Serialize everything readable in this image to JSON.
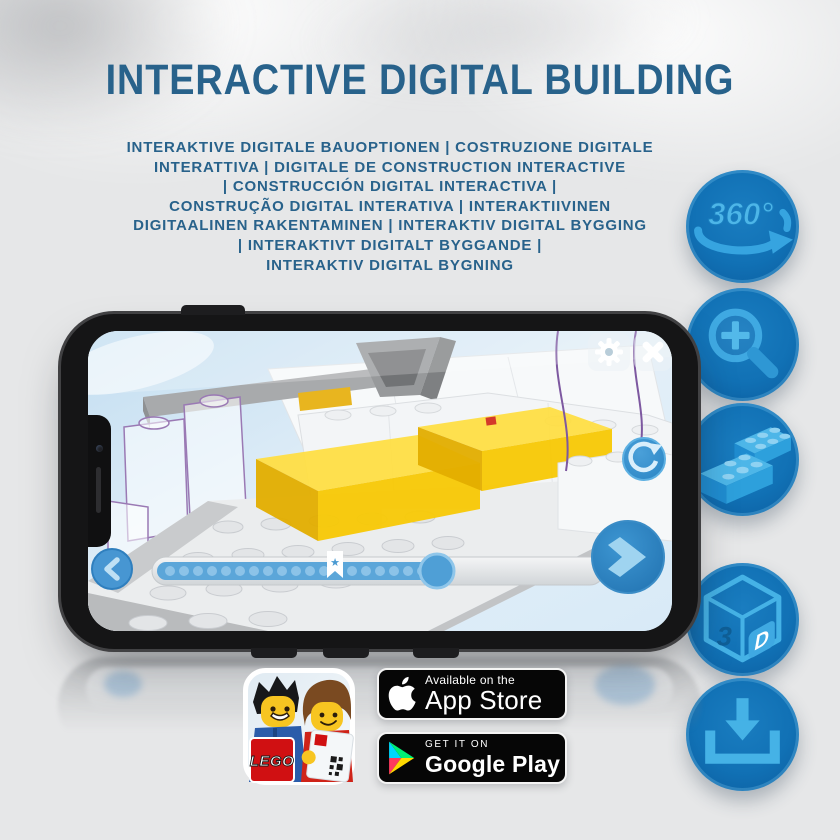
{
  "header": {
    "title": "INTERACTIVE DIGITAL BUILDING",
    "subtitle_lines": [
      "INTERAKTIVE DIGITALE BAUOPTIONEN | COSTRUZIONE DIGITALE",
      "INTERATTIVA | DIGITALE DE CONSTRUCTION INTERACTIVE",
      "| CONSTRUCCIÓN DIGITAL INTERACTIVA |",
      "CONSTRUÇÃO DIGITAL INTERATIVA | INTERAKTIIVINEN",
      "DIGITAALINEN RAKENTAMINEN | INTERAKTIV DIGITAL BYGGING",
      "| INTERAKTIVT DIGITALT BYGGANDE |",
      "INTERAKTIV DIGITAL BYGNING"
    ]
  },
  "feature_icons": {
    "rotate360": {
      "label": "360°"
    },
    "threed": {
      "label_3": "3",
      "label_d": "D"
    }
  },
  "app_icon": {
    "lego_text": "LEGO"
  },
  "badges": {
    "app_store": {
      "tagline": "Available on the",
      "store": "App Store"
    },
    "google_play": {
      "tagline": "GET IT ON",
      "store": "Google Play"
    }
  },
  "colors": {
    "background": "#e6e7e8",
    "title_blue": "#28628b",
    "icon_circle_blue": "#1171b5",
    "icon_glyph_blue": "#42b0e6",
    "app_button_blue": "#3b91cf",
    "brick_yellow": "#f8c905",
    "badge_black": "#060606",
    "lego_red": "#d01012"
  }
}
